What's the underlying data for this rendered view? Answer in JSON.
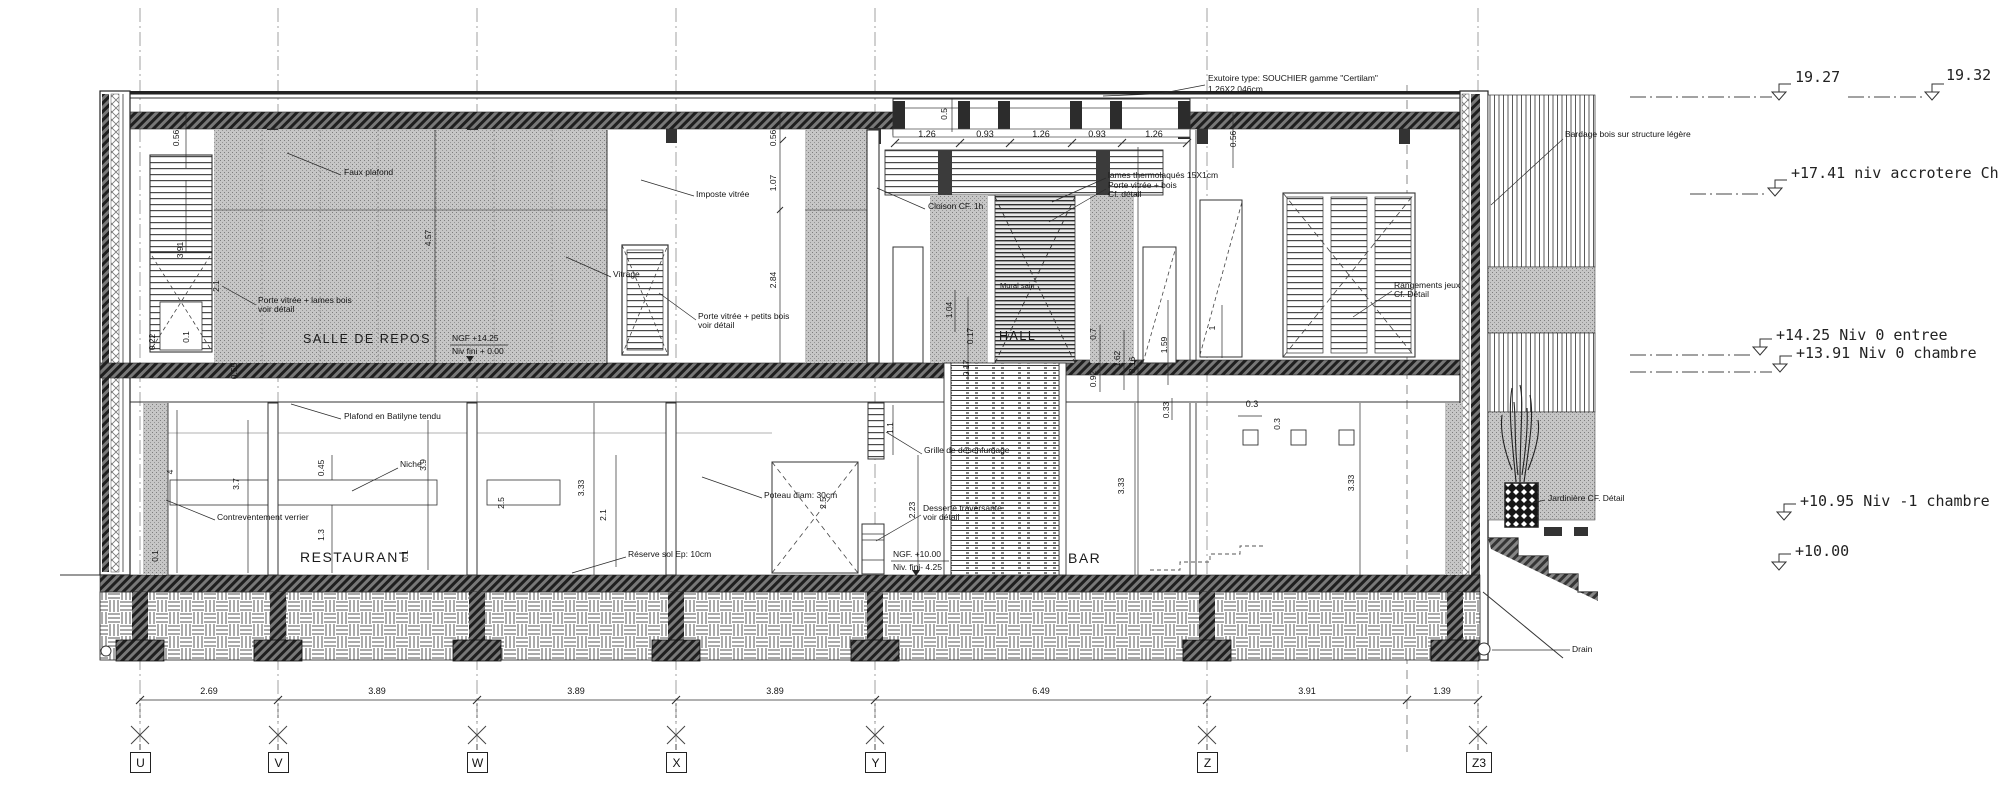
{
  "drawing": {
    "rooms": {
      "salle_de_repos": "SALLE DE REPOS",
      "hall": "HALL",
      "restaurant": "RESTAURANT",
      "bar": "BAR"
    },
    "levels": {
      "l1927": "19.27",
      "l1932": "19.32",
      "l1741": "+17.41 niv accrotere Ch.",
      "l1425": "+14.25 Niv 0 entree",
      "l1391": "+13.91 Niv 0 chambre",
      "l1095": "+10.95 Niv -1 chambre",
      "l1000": "+10.00"
    },
    "ngf": {
      "up1": "NGF +14.25",
      "up2": "Niv fini + 0.00",
      "low1": "NGF. +10.00",
      "low2": "Niv. fini- 4.25"
    },
    "annotations": {
      "exutoire1": "Exutoire type: SOUCHIER gamme \"Certilam\"",
      "exutoire2": "1.26X2.046cm",
      "bardage": "Bardage bois sur structure légère",
      "faux_plafond": "Faux plafond",
      "imposte": "Imposte vitrée",
      "vitrage": "Vitrage",
      "porte_lames1": "Porte vitrée + lames bois",
      "porte_lames2": "voir détail",
      "porte_petits1": "Porte vitrée + petits bois",
      "porte_petits2": "voir détail",
      "cloison": "Cloison CF. 1h",
      "lames_thermo": "lames thermolaqués 15X1cm",
      "porte_bois1": "Porte vitrée + bois",
      "porte_bois2": "Cf. détail",
      "mural": "Mural sain",
      "rangements1": "Rangements jeux",
      "rangements2": "Cf. Détail",
      "plafond_batilyne": "Plafond en Batilyne tendu",
      "niche": "Niche",
      "contreventement": "Contreventement verrier",
      "poteau": "Poteau diam: 30cm",
      "reserve": "Réserve sol Ep: 10cm",
      "grille": "Grille de désenfumage",
      "desserte1": "Desserte traversante",
      "desserte2": "voir détail",
      "jardiniere": "Jardinière CF. Détail",
      "drain": "Drain"
    },
    "dims_top": [
      "1.26",
      "0.93",
      "1.26",
      "0.93",
      "1.26"
    ],
    "dim_roof_h": "0.5",
    "dims_bottom": [
      "2.69",
      "3.89",
      "3.89",
      "3.89",
      "6.49",
      "3.91",
      "1.39"
    ],
    "grid_labels": [
      "U",
      "V",
      "W",
      "X",
      "Y",
      "Z",
      "Z3"
    ],
    "vdims": [
      "0.56",
      "3.91",
      "2.1",
      "0.1",
      "0.22",
      "0.55",
      "4.57",
      "0.56",
      "1.07",
      "2.84",
      "0.56",
      "1.04",
      "0.17",
      "0.17",
      "0.7",
      "1.62",
      "8.16",
      "0.92",
      "1.59",
      "1",
      "0.33",
      "1.1",
      "2.23",
      "4",
      "3.7",
      "0.45",
      "3.9",
      "1.3",
      "0.1",
      "0.1",
      "2.5",
      "3.33",
      "2.1",
      "2.5",
      "3.33",
      "3.33",
      "0.3",
      "0.3"
    ]
  }
}
